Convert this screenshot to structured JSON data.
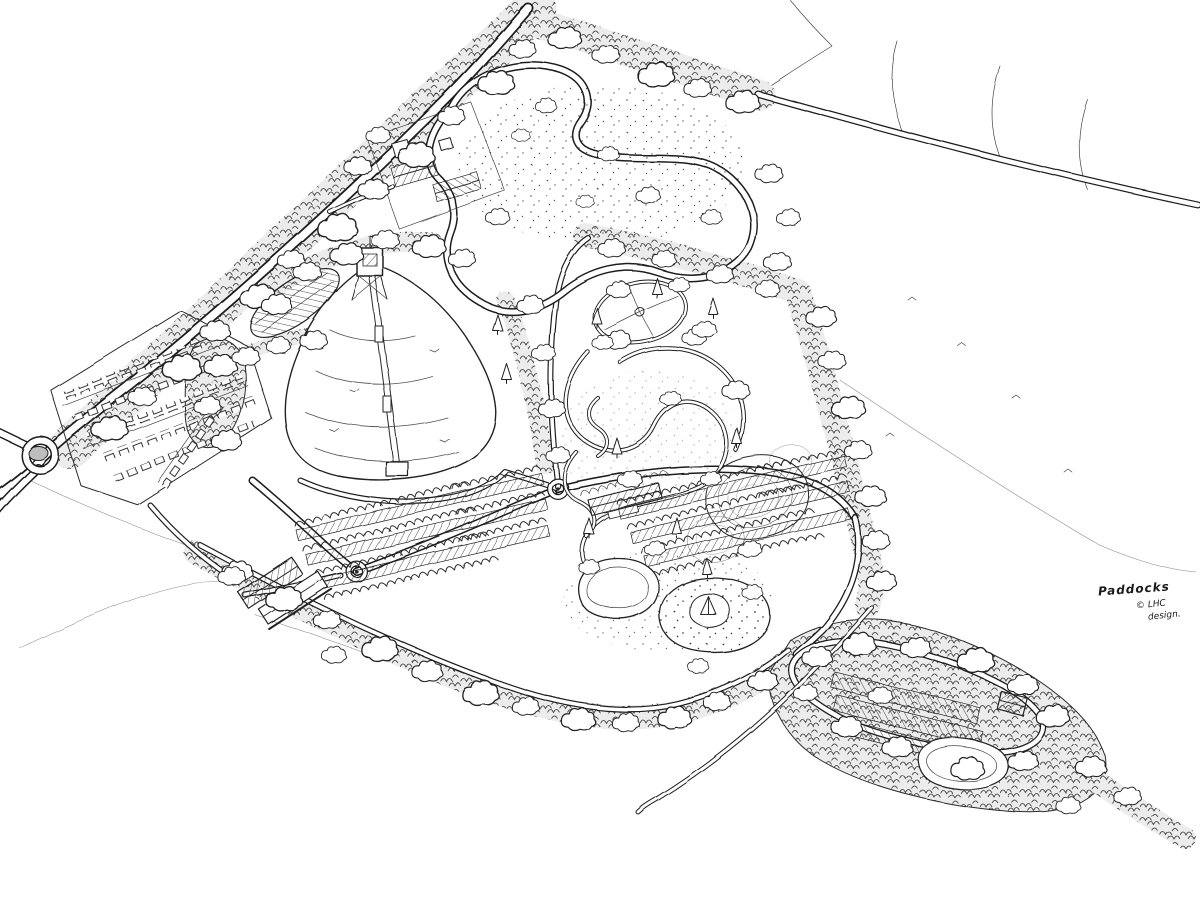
{
  "artwork": {
    "title": "Hand-drawn aerial masterplan sketch of a leisure park site",
    "medium": "pen and ink line drawing",
    "signature": "Paddocks",
    "credit_line1": "© LHC",
    "credit_line2": "design."
  },
  "palette": {
    "ink": "#222222",
    "paper": "#ffffff",
    "shading": "#bdbdbd"
  },
  "features": [
    {
      "id": "main-road",
      "label": "perimeter road with tree avenue"
    },
    {
      "id": "site-roundabout",
      "label": "entrance roundabout"
    },
    {
      "id": "car-park",
      "label": "visitor car park with bays"
    },
    {
      "id": "farmstead",
      "label": "farmstead buildings"
    },
    {
      "id": "north-meadow",
      "label": "meadow with looping path and scattered trees"
    },
    {
      "id": "ski-slope",
      "label": "fan-shaped dry ski slope"
    },
    {
      "id": "ski-lift",
      "label": "ski lift line with tower and stations"
    },
    {
      "id": "nursery-slope",
      "label": "shaded nursery slope"
    },
    {
      "id": "activity-glade",
      "label": "oval activity glade with radial paths"
    },
    {
      "id": "trail-loops",
      "label": "winding trail loops through trees"
    },
    {
      "id": "earth-mounds",
      "label": "contoured play mounds"
    },
    {
      "id": "visitor-lodge",
      "label": "lodge building"
    },
    {
      "id": "pitch-rows",
      "label": "rows of lodge pitches with tree rows"
    },
    {
      "id": "garden-ponds",
      "label": "stippled ponds with island and pyramid feature"
    },
    {
      "id": "barns",
      "label": "pair of barn sheds"
    },
    {
      "id": "south-lane",
      "label": "southern hedgerow lane"
    },
    {
      "id": "camping-loop",
      "label": "camping field loop with pitches"
    },
    {
      "id": "se-woodland",
      "label": "south-east woodland and pond"
    },
    {
      "id": "open-fields",
      "label": "surrounding open fields with hedgerows"
    }
  ]
}
